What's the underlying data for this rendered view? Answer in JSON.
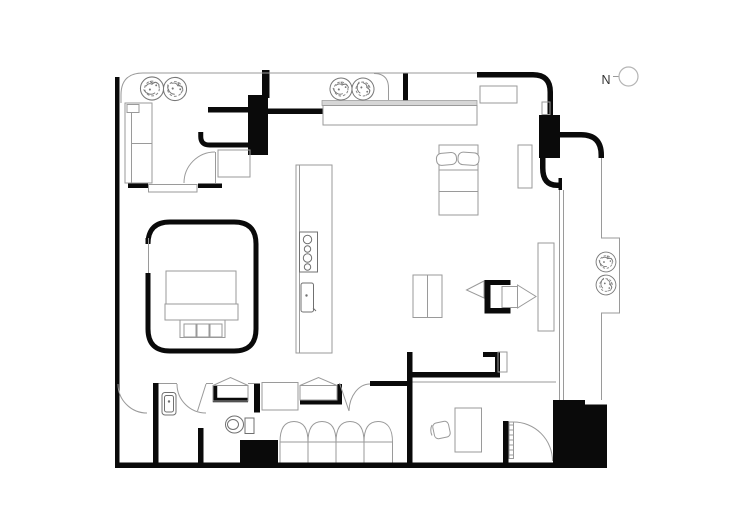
{
  "canvas": {
    "width": 750,
    "height": 530
  },
  "north_indicator": {
    "label": "N"
  },
  "colors": {
    "background": "#ffffff",
    "wall": "#0a0a0a",
    "furniture_line": "#9a9a9a",
    "fixture_line": "#707070",
    "counter_fill": "#d6d6d6",
    "north_text": "#333333"
  }
}
